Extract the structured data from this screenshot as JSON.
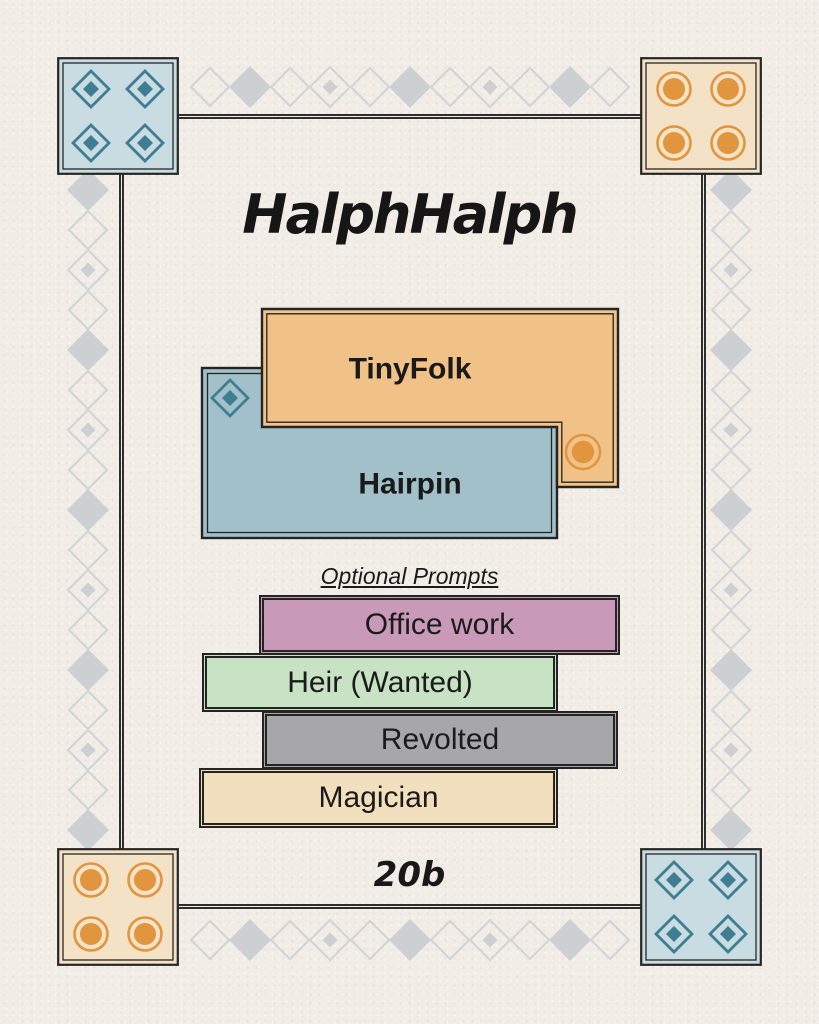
{
  "page": {
    "title": "HalphHalph",
    "footer_code": "20b",
    "background_color": "#f1ece5",
    "frame_border_color": "#2e2e2e"
  },
  "cards": [
    {
      "label": "TinyFolk",
      "color": "#f1c287",
      "icon": "circle-icon",
      "icon_color": "#e0953e"
    },
    {
      "label": "Hairpin",
      "color": "#a2c0ca",
      "icon": "diamond-icon",
      "icon_color": "#3e7d92"
    }
  ],
  "prompts": {
    "heading": "Optional Prompts",
    "items": [
      {
        "label": "Office work",
        "color": "#c99ab8"
      },
      {
        "label": "Heir (Wanted)",
        "color": "#c8e3c3"
      },
      {
        "label": "Revolted",
        "color": "#a7a7a9"
      },
      {
        "label": "Magician",
        "color": "#f2dfbd"
      }
    ]
  },
  "corners": {
    "top_left": {
      "style": "diamond-icons",
      "background": "#c9dce2"
    },
    "top_right": {
      "style": "circle-icons",
      "background": "#f4e2c7"
    },
    "bottom_left": {
      "style": "circle-icons",
      "background": "#f4e2c7"
    },
    "bottom_right": {
      "style": "diamond-icons",
      "background": "#c9dce2"
    }
  },
  "decoration": {
    "chain_fill": "#ccd0d3",
    "chain_outline": "#d2d5d7",
    "diamond_color": "#3e7d92",
    "circle_color": "#e0953e"
  }
}
